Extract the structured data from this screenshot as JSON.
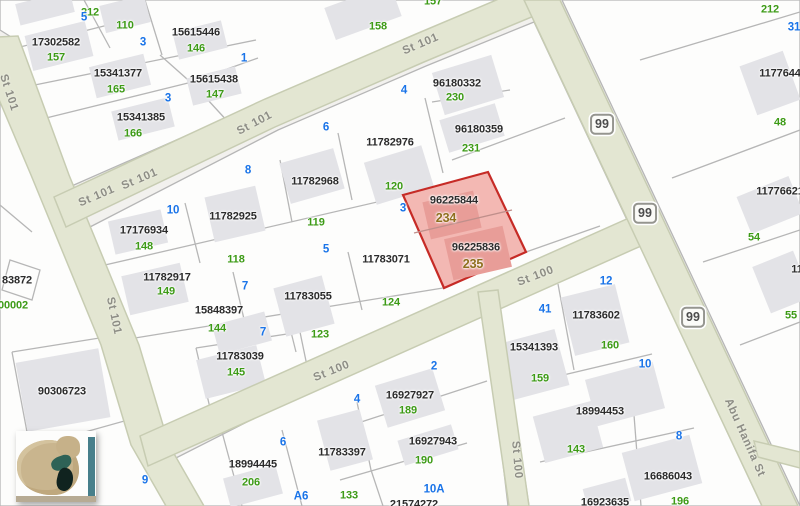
{
  "map": {
    "highlighted_parcel": {
      "parcel_ids": [
        "96225844",
        "96225836"
      ],
      "plot_numbers": [
        "234",
        "235"
      ]
    },
    "parcel_numbers": [
      {
        "t": "17302582",
        "x": 56,
        "y": 43
      },
      {
        "t": "15615446",
        "x": 196,
        "y": 33
      },
      {
        "t": "15341377",
        "x": 118,
        "y": 74
      },
      {
        "t": "15615438",
        "x": 214,
        "y": 80
      },
      {
        "t": "15341385",
        "x": 141,
        "y": 118
      },
      {
        "t": "96180332",
        "x": 457,
        "y": 84
      },
      {
        "t": "96180359",
        "x": 479,
        "y": 130
      },
      {
        "t": "11782976",
        "x": 390,
        "y": 143
      },
      {
        "t": "11782968",
        "x": 315,
        "y": 182
      },
      {
        "t": "11782925",
        "x": 233,
        "y": 217
      },
      {
        "t": "17176934",
        "x": 144,
        "y": 231
      },
      {
        "t": "11782917",
        "x": 167,
        "y": 278
      },
      {
        "t": "11783071",
        "x": 386,
        "y": 260
      },
      {
        "t": "11783055",
        "x": 308,
        "y": 297
      },
      {
        "t": "15848397",
        "x": 219,
        "y": 311
      },
      {
        "t": "11783039",
        "x": 240,
        "y": 357
      },
      {
        "t": "96225844",
        "x": 454,
        "y": 201
      },
      {
        "t": "96225836",
        "x": 476,
        "y": 248
      },
      {
        "t": "90306723",
        "x": 62,
        "y": 392
      },
      {
        "t": "83872",
        "x": 17,
        "y": 281
      },
      {
        "t": "16927927",
        "x": 410,
        "y": 396
      },
      {
        "t": "16927943",
        "x": 433,
        "y": 442
      },
      {
        "t": "11783397",
        "x": 342,
        "y": 453
      },
      {
        "t": "18994445",
        "x": 253,
        "y": 465
      },
      {
        "t": "21574272",
        "x": 414,
        "y": 505
      },
      {
        "t": "15341393",
        "x": 534,
        "y": 348
      },
      {
        "t": "11783602",
        "x": 596,
        "y": 316
      },
      {
        "t": "18994453",
        "x": 600,
        "y": 412
      },
      {
        "t": "16686043",
        "x": 668,
        "y": 477
      },
      {
        "t": "16923635",
        "x": 605,
        "y": 503
      },
      {
        "t": "11776445",
        "x": 783,
        "y": 74
      },
      {
        "t": "11776621",
        "x": 780,
        "y": 192
      },
      {
        "t": "11",
        "x": 797,
        "y": 270
      }
    ],
    "plot_numbers": [
      {
        "t": "212",
        "x": 90,
        "y": 13
      },
      {
        "t": "110",
        "x": 125,
        "y": 26
      },
      {
        "t": "157",
        "x": 56,
        "y": 58
      },
      {
        "t": "146",
        "x": 196,
        "y": 49
      },
      {
        "t": "165",
        "x": 116,
        "y": 90
      },
      {
        "t": "147",
        "x": 215,
        "y": 95
      },
      {
        "t": "166",
        "x": 133,
        "y": 134
      },
      {
        "t": "158",
        "x": 378,
        "y": 27
      },
      {
        "t": "157",
        "x": 433,
        "y": 2
      },
      {
        "t": "230",
        "x": 455,
        "y": 98
      },
      {
        "t": "231",
        "x": 471,
        "y": 149
      },
      {
        "t": "120",
        "x": 394,
        "y": 187
      },
      {
        "t": "119",
        "x": 316,
        "y": 223
      },
      {
        "t": "118",
        "x": 236,
        "y": 260
      },
      {
        "t": "148",
        "x": 144,
        "y": 247
      },
      {
        "t": "149",
        "x": 166,
        "y": 292
      },
      {
        "t": "144",
        "x": 217,
        "y": 329
      },
      {
        "t": "124",
        "x": 391,
        "y": 303
      },
      {
        "t": "123",
        "x": 320,
        "y": 335
      },
      {
        "t": "145",
        "x": 236,
        "y": 373
      },
      {
        "t": "00002",
        "x": 13,
        "y": 306
      },
      {
        "t": "206",
        "x": 251,
        "y": 483
      },
      {
        "t": "133",
        "x": 349,
        "y": 496
      },
      {
        "t": "190",
        "x": 424,
        "y": 461
      },
      {
        "t": "189",
        "x": 408,
        "y": 411
      },
      {
        "t": "159",
        "x": 540,
        "y": 379
      },
      {
        "t": "160",
        "x": 610,
        "y": 346
      },
      {
        "t": "143",
        "x": 576,
        "y": 450
      },
      {
        "t": "196",
        "x": 680,
        "y": 502
      },
      {
        "t": "212",
        "x": 770,
        "y": 10
      },
      {
        "t": "48",
        "x": 780,
        "y": 123
      },
      {
        "t": "54",
        "x": 754,
        "y": 238
      },
      {
        "t": "55",
        "x": 791,
        "y": 316
      }
    ],
    "unit_numbers": [
      {
        "t": "5",
        "x": 84,
        "y": 18
      },
      {
        "t": "3",
        "x": 143,
        "y": 43
      },
      {
        "t": "1",
        "x": 244,
        "y": 59
      },
      {
        "t": "3",
        "x": 168,
        "y": 99
      },
      {
        "t": "4",
        "x": 404,
        "y": 91
      },
      {
        "t": "6",
        "x": 326,
        "y": 128
      },
      {
        "t": "8",
        "x": 248,
        "y": 171
      },
      {
        "t": "10",
        "x": 173,
        "y": 211
      },
      {
        "t": "3",
        "x": 403,
        "y": 209
      },
      {
        "t": "5",
        "x": 326,
        "y": 250
      },
      {
        "t": "7",
        "x": 245,
        "y": 287
      },
      {
        "t": "7",
        "x": 263,
        "y": 333
      },
      {
        "t": "12",
        "x": 606,
        "y": 282
      },
      {
        "t": "41",
        "x": 545,
        "y": 310
      },
      {
        "t": "10",
        "x": 645,
        "y": 365
      },
      {
        "t": "2",
        "x": 434,
        "y": 367
      },
      {
        "t": "4",
        "x": 357,
        "y": 400
      },
      {
        "t": "6",
        "x": 283,
        "y": 443
      },
      {
        "t": "9",
        "x": 145,
        "y": 481
      },
      {
        "t": "A6",
        "x": 301,
        "y": 497
      },
      {
        "t": "10A",
        "x": 434,
        "y": 490
      },
      {
        "t": "8",
        "x": 679,
        "y": 437
      },
      {
        "t": "31",
        "x": 794,
        "y": 28
      }
    ],
    "selected_plot_numbers": [
      {
        "t": "234",
        "x": 446,
        "y": 218
      },
      {
        "t": "235",
        "x": 473,
        "y": 264
      }
    ],
    "road_labels": [
      {
        "t": "St 101",
        "x": 8,
        "y": 93,
        "rot": 72
      },
      {
        "t": "St 101",
        "x": 97,
        "y": 197,
        "rot": -23
      },
      {
        "t": "St 101",
        "x": 140,
        "y": 180,
        "rot": -23
      },
      {
        "t": "St 101",
        "x": 255,
        "y": 124,
        "rot": -28
      },
      {
        "t": "St 101",
        "x": 421,
        "y": 45,
        "rot": -23
      },
      {
        "t": "St 101",
        "x": 113,
        "y": 316,
        "rot": 78
      },
      {
        "t": "St 100",
        "x": 332,
        "y": 372,
        "rot": -22
      },
      {
        "t": "St 100",
        "x": 536,
        "y": 277,
        "rot": -21
      },
      {
        "t": "St 100",
        "x": 516,
        "y": 460,
        "rot": 85
      },
      {
        "t": "Abu Hanifa St",
        "x": 744,
        "y": 438,
        "rot": 66
      }
    ],
    "route_badges": [
      {
        "t": "99",
        "x": 602,
        "y": 124
      },
      {
        "t": "99",
        "x": 645,
        "y": 213
      },
      {
        "t": "99",
        "x": 693,
        "y": 317
      }
    ],
    "colors": {
      "background": "#f2f1ee",
      "block_fill": "#fdfdfc",
      "parcel_line": "#b6b6b6",
      "building_fill": "#e3e3e7",
      "road_fill": "#e3e6d2",
      "road_edge": "#c7ccb2",
      "parcel_number": "#2b2b2b",
      "plot_number_green": "#3d9b16",
      "unit_number_blue": "#1a74e8",
      "selected_plot_olive": "#8f6f1e",
      "highlight_fill": "#f1aba6",
      "highlight_border": "#c62b26"
    }
  }
}
